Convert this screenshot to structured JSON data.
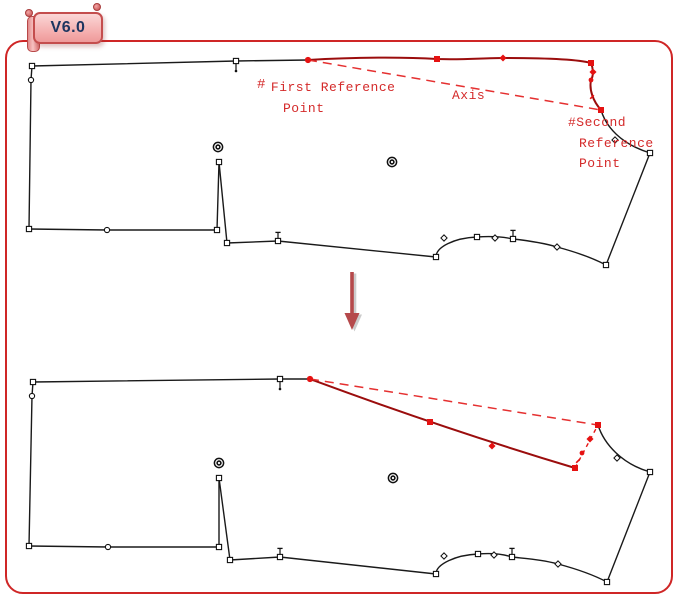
{
  "badge": {
    "version_label": "V6.0"
  },
  "annotations": {
    "first_reference_hash": "#",
    "first_reference_line1": "First Reference",
    "first_reference_line2": "Point",
    "axis_label": "Axis",
    "second_reference_line1": "#Second",
    "second_reference_line2": "Reference",
    "second_reference_line3": "Point"
  },
  "colors": {
    "frame_border": "#cf2626",
    "annotation_red": "#d42a2a",
    "dashed_axis_red": "#e53030",
    "selected_edge_dark_red": "#9b0d0d",
    "marker_red": "#e51212",
    "outline_black": "#1a1a1a",
    "arrow_red": "#b5494b",
    "badge_fill": "#f3a8a8",
    "badge_border": "#c44d4d",
    "badge_text": "#1e3560"
  }
}
